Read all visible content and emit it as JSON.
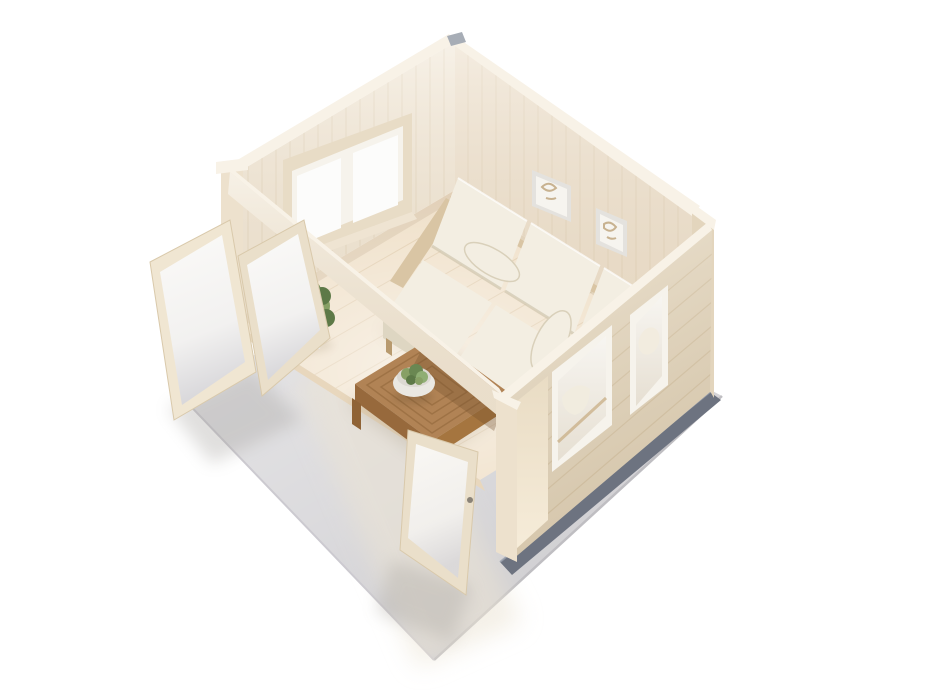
{
  "meta": {
    "kind": "3d-product-render",
    "subject": "wooden-garden-cabin-interior-cutaway",
    "view": "aerial-isometric",
    "background": "#ffffff"
  },
  "palette": {
    "bg": "#ffffff",
    "slab": "#d6d5d8",
    "slab_edge": "#bfbec2",
    "foundation": "#6d7380",
    "floor": "#f0e1ca",
    "threshold": "#e8d7bd",
    "wall_left": "#f3eadb",
    "wall_right": "#efe3d1",
    "wall_exterior": "#e9dcc4",
    "wall_top": "#f8f2e7",
    "corner_dark": "#e3d5bd",
    "beam": "#f2e9d9",
    "post": "#ede1cd",
    "window_frame": "#e8dcc6",
    "window_inner": "#f6f3ec",
    "glass_bright": "#fcfcfb",
    "glass_cool": "#dfdee1",
    "door_frame": "#eadfca",
    "sofa_cushion": "#f3eee2",
    "sofa_front": "#ded6c2",
    "sofa_wood": "#d9c5a4",
    "table_top": "#b18355",
    "table_side": "#97693c",
    "bowl": "#eae8e2",
    "succulent": "#87a065",
    "plant_green": "#6a8752",
    "plant_dark": "#5d7947",
    "plant_light": "#8fae74",
    "pot": "#e8e6e2",
    "picture_frame": "#e4e2de",
    "picture_mat": "#f6f4ef",
    "picture_art": "#c8b290",
    "metal": "#a7adb6",
    "shadow": "#8d7a5c"
  },
  "objects": {
    "terrace_slab": "concrete-terrace-slab",
    "foundation": "foundation-strip",
    "floor": "interior-wood-floor",
    "back_left_wall": "log-wall-with-double-window",
    "back_right_wall": "log-wall-with-two-pictures",
    "front_right_wall": "exterior-log-wall-with-door-and-windows",
    "header_beam": "front-opening-header-beam",
    "french_door_left": "open-glazed-door-leaf-outer",
    "french_door_right": "open-glazed-door-leaf-inner",
    "front_door": "open-glazed-front-door-leaf",
    "sofa": "three-seat-cream-sofa",
    "coffee_table": "wooden-coffee-table",
    "bowl": "bowl-of-succulents",
    "plant": "potted-green-plant",
    "pictures": "two-framed-wall-pictures"
  }
}
